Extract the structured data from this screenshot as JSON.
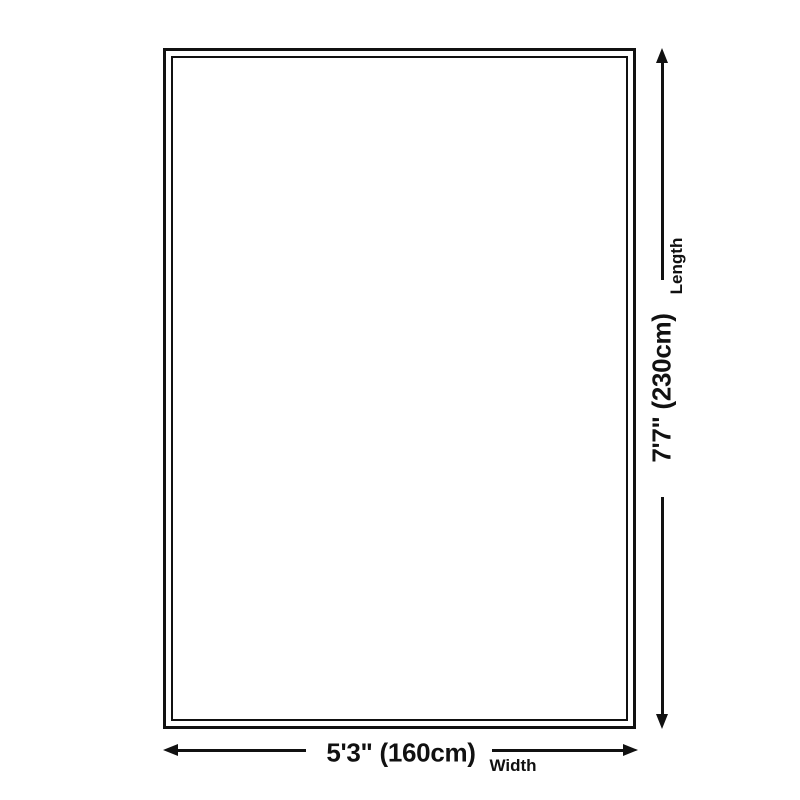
{
  "diagram": {
    "title": "rug-size-diagram",
    "colors": {
      "ink": "#111111",
      "background": "#ffffff"
    },
    "rug": {
      "shape": "rectangle",
      "border_style": "double-outline"
    },
    "length": {
      "value": "7'7\" (230cm)",
      "label": "Length"
    },
    "width": {
      "value": "5'3\" (160cm)",
      "label": "Width"
    }
  }
}
